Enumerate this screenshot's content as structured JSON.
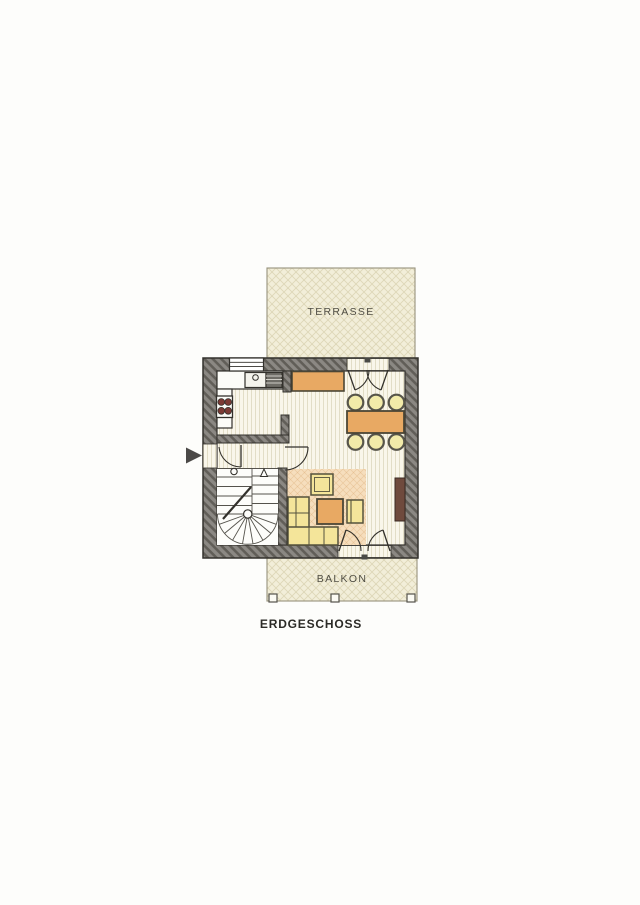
{
  "title": {
    "label": "ERDGESCHOSS"
  },
  "areas": {
    "terrace": {
      "label": "TERRASSE"
    },
    "balcony": {
      "label": "BALKON"
    }
  },
  "icons": {
    "entry_marker": "entrance-arrow"
  },
  "colors": {
    "paper": "#fdfdfb",
    "line": "#33312c",
    "wall_light": "#8b8883",
    "wall_dark": "#615e58",
    "floor_bg": "#f9f6ea",
    "floor_stripe": "#e2ddc6",
    "lattice_bg": "#f2eed9",
    "lattice_line": "#ddd7b8",
    "orange": "#e8a963",
    "yellow": "#f4e59a",
    "rug": "#f6debd",
    "rug_line": "#dcae77",
    "radiator": "#6f4a3d",
    "burner": "#7c3a35",
    "label_text": "#504e44",
    "title_text": "#2c2b27",
    "arrow": "#4b4947"
  }
}
